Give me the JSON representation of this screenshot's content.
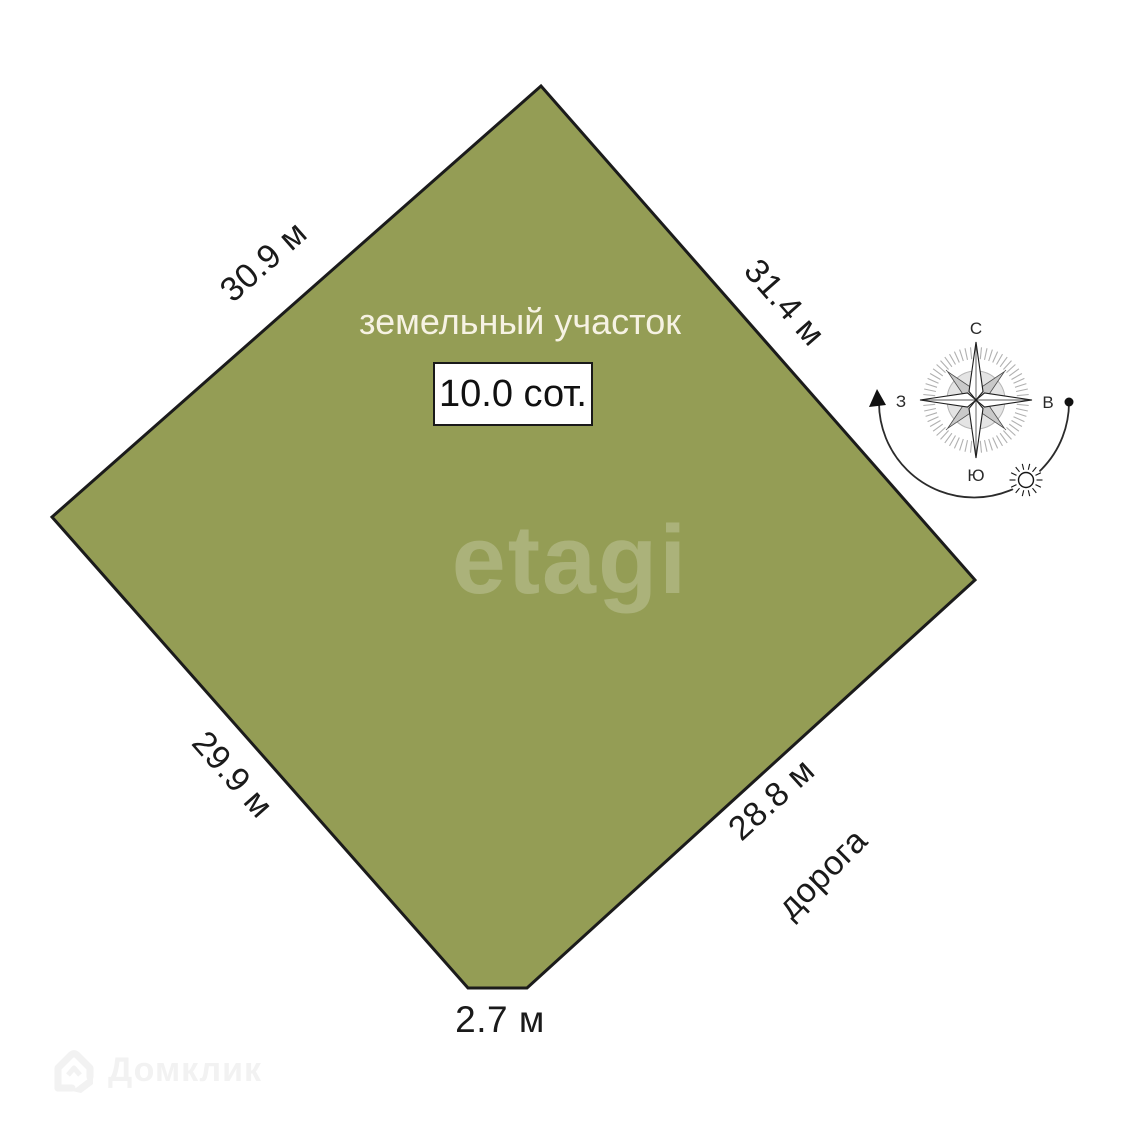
{
  "plot": {
    "title": "земельный участок",
    "area_label": "10.0 сот.",
    "colors": {
      "fill": "#949d55",
      "stroke": "#1b1b1b"
    }
  },
  "measurements": {
    "side_top_left": "30.9 м",
    "side_top_right": "31.4 м",
    "side_bottom_left": "29.9 м",
    "side_bottom_right": "28.8 м",
    "side_bottom": "2.7 м"
  },
  "road_label": "дорога",
  "compass": {
    "north": "С",
    "south": "Ю",
    "west": "З",
    "east": "В"
  },
  "watermarks": {
    "center_logo": "etagi",
    "bottom_left_logo": "Домклик"
  }
}
